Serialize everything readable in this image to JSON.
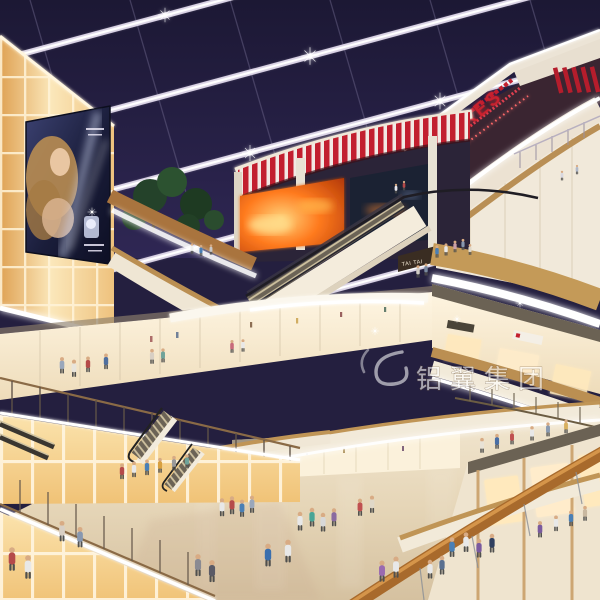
{
  "scene": {
    "title": "Shopping mall atrium interior rendering",
    "colors": {
      "skylight_navy": "#262148",
      "mullion_white": "#e6e0ee",
      "theatre_red": "#c21e2e",
      "cream_fascia": "#f0e7d8",
      "wood_fascia": "#c49a58",
      "amber_glow": "#f6d191",
      "floor_beige": "#e3d5bc",
      "billboard_navy": "#262b4e",
      "foliage_green": "#27462a",
      "fire_screen_orange": "#ff7b1f"
    }
  },
  "signs": {
    "theatres": "THEATRES",
    "tai_tai": "TAI TAI"
  },
  "watermark": {
    "text": "铝翼集团"
  }
}
